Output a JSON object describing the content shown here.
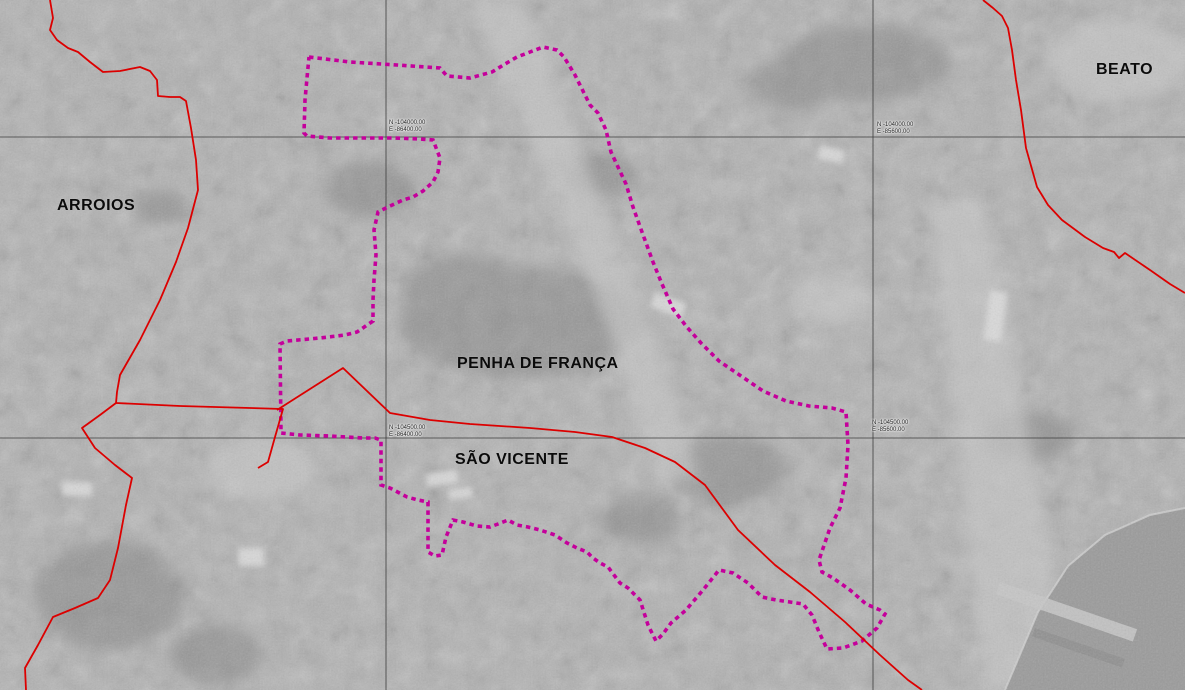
{
  "map": {
    "description": "Grayscale aerial orthophoto of Lisbon with parish boundaries and intervention area overlay",
    "colors": {
      "boundary_red": "#dc0000",
      "intervention_magenta": "#c4009b",
      "grid_black": "#3c3c3c",
      "photo_base_gray": "#b2b2b2"
    },
    "regions": [
      {
        "name": "ARROIOS",
        "x": 57,
        "y": 197
      },
      {
        "name": "PENHA DE FRANÇA",
        "x": 457,
        "y": 355
      },
      {
        "name": "SÃO VICENTE",
        "x": 455,
        "y": 451
      },
      {
        "name": "BEATO",
        "x": 1096,
        "y": 61
      }
    ],
    "grid": {
      "horizontal": [
        137,
        438
      ],
      "vertical": [
        386,
        873
      ],
      "labels": [
        {
          "n": "N -104000.00",
          "e": "E -86400.00",
          "x": 389,
          "y": 120
        },
        {
          "n": "N -104000.00",
          "e": "E -85600.00",
          "x": 877,
          "y": 122
        },
        {
          "n": "N -104500.00",
          "e": "E -86400.00",
          "x": 389,
          "y": 425
        },
        {
          "n": "N -104500.00",
          "e": "E -85600.00",
          "x": 872,
          "y": 420
        }
      ]
    },
    "boundaries": {
      "stroke_width": 1.8,
      "paths": [
        [
          [
            50,
            0
          ],
          [
            53,
            18
          ],
          [
            50,
            30
          ],
          [
            57,
            40
          ],
          [
            68,
            48
          ],
          [
            78,
            52
          ],
          [
            90,
            62
          ],
          [
            103,
            72
          ],
          [
            120,
            71
          ],
          [
            140,
            67
          ],
          [
            150,
            71
          ],
          [
            157,
            80
          ],
          [
            158,
            96
          ],
          [
            170,
            97
          ],
          [
            180,
            97
          ],
          [
            186,
            101
          ],
          [
            191,
            128
          ],
          [
            196,
            160
          ],
          [
            198,
            190
          ],
          [
            188,
            228
          ],
          [
            176,
            262
          ],
          [
            160,
            300
          ],
          [
            140,
            340
          ],
          [
            120,
            375
          ],
          [
            117,
            392
          ],
          [
            116,
            403
          ],
          [
            100,
            415
          ],
          [
            82,
            428
          ],
          [
            95,
            448
          ],
          [
            115,
            465
          ],
          [
            132,
            478
          ],
          [
            126,
            505
          ],
          [
            118,
            548
          ],
          [
            110,
            580
          ],
          [
            98,
            598
          ],
          [
            75,
            608
          ],
          [
            53,
            617
          ],
          [
            38,
            645
          ],
          [
            25,
            668
          ],
          [
            26,
            690
          ]
        ],
        [
          [
            116,
            403
          ],
          [
            180,
            406
          ],
          [
            250,
            408
          ],
          [
            283,
            409
          ],
          [
            275,
            437
          ],
          [
            268,
            462
          ],
          [
            258,
            468
          ]
        ],
        [
          [
            277,
            410
          ],
          [
            310,
            389
          ],
          [
            343,
            368
          ],
          [
            367,
            391
          ],
          [
            390,
            413
          ],
          [
            430,
            420
          ],
          [
            470,
            424
          ],
          [
            530,
            428
          ],
          [
            575,
            432
          ],
          [
            612,
            437
          ],
          [
            645,
            448
          ],
          [
            675,
            462
          ],
          [
            705,
            485
          ],
          [
            738,
            530
          ],
          [
            775,
            565
          ],
          [
            810,
            592
          ],
          [
            845,
            622
          ],
          [
            880,
            655
          ],
          [
            908,
            680
          ],
          [
            922,
            690
          ]
        ],
        [
          [
            983,
            0
          ],
          [
            993,
            8
          ],
          [
            1002,
            16
          ],
          [
            1008,
            28
          ],
          [
            1012,
            50
          ],
          [
            1016,
            80
          ],
          [
            1021,
            110
          ],
          [
            1026,
            148
          ],
          [
            1037,
            187
          ],
          [
            1048,
            205
          ],
          [
            1062,
            220
          ],
          [
            1085,
            237
          ],
          [
            1103,
            248
          ],
          [
            1114,
            252
          ],
          [
            1119,
            258
          ],
          [
            1125,
            253
          ],
          [
            1150,
            270
          ],
          [
            1170,
            284
          ],
          [
            1185,
            293
          ]
        ]
      ]
    },
    "intervention_area": {
      "stroke_width": 3.6,
      "dash": "4.5 4",
      "path": [
        [
          309,
          57
        ],
        [
          350,
          62
        ],
        [
          397,
          65
        ],
        [
          440,
          68
        ],
        [
          447,
          76
        ],
        [
          470,
          78
        ],
        [
          492,
          72
        ],
        [
          505,
          64
        ],
        [
          517,
          57
        ],
        [
          530,
          52
        ],
        [
          543,
          47
        ],
        [
          557,
          50
        ],
        [
          564,
          57
        ],
        [
          575,
          75
        ],
        [
          590,
          105
        ],
        [
          598,
          113
        ],
        [
          606,
          130
        ],
        [
          611,
          152
        ],
        [
          618,
          167
        ],
        [
          626,
          184
        ],
        [
          633,
          207
        ],
        [
          642,
          232
        ],
        [
          653,
          262
        ],
        [
          662,
          284
        ],
        [
          673,
          309
        ],
        [
          686,
          326
        ],
        [
          701,
          343
        ],
        [
          719,
          361
        ],
        [
          741,
          376
        ],
        [
          763,
          391
        ],
        [
          786,
          401
        ],
        [
          809,
          406
        ],
        [
          832,
          408
        ],
        [
          846,
          412
        ],
        [
          848,
          445
        ],
        [
          846,
          478
        ],
        [
          840,
          508
        ],
        [
          830,
          528
        ],
        [
          819,
          560
        ],
        [
          822,
          572
        ],
        [
          833,
          578
        ],
        [
          850,
          590
        ],
        [
          866,
          604
        ],
        [
          880,
          610
        ],
        [
          885,
          614
        ],
        [
          877,
          628
        ],
        [
          862,
          641
        ],
        [
          843,
          648
        ],
        [
          827,
          649
        ],
        [
          819,
          632
        ],
        [
          812,
          615
        ],
        [
          803,
          604
        ],
        [
          790,
          602
        ],
        [
          776,
          600
        ],
        [
          762,
          597
        ],
        [
          748,
          583
        ],
        [
          733,
          573
        ],
        [
          719,
          570
        ],
        [
          703,
          590
        ],
        [
          686,
          610
        ],
        [
          671,
          623
        ],
        [
          663,
          634
        ],
        [
          656,
          641
        ],
        [
          648,
          625
        ],
        [
          640,
          600
        ],
        [
          628,
          588
        ],
        [
          620,
          583
        ],
        [
          608,
          567
        ],
        [
          600,
          563
        ],
        [
          593,
          558
        ],
        [
          587,
          552
        ],
        [
          577,
          548
        ],
        [
          567,
          543
        ],
        [
          555,
          535
        ],
        [
          540,
          530
        ],
        [
          528,
          527
        ],
        [
          517,
          525
        ],
        [
          508,
          520
        ],
        [
          498,
          524
        ],
        [
          490,
          527
        ],
        [
          477,
          526
        ],
        [
          463,
          522
        ],
        [
          453,
          520
        ],
        [
          446,
          537
        ],
        [
          442,
          555
        ],
        [
          435,
          556
        ],
        [
          428,
          552
        ],
        [
          428,
          502
        ],
        [
          418,
          500
        ],
        [
          407,
          497
        ],
        [
          390,
          488
        ],
        [
          381,
          485
        ],
        [
          381,
          440
        ],
        [
          375,
          438
        ],
        [
          363,
          438
        ],
        [
          330,
          436
        ],
        [
          300,
          435
        ],
        [
          281,
          433
        ],
        [
          280,
          344
        ],
        [
          287,
          341
        ],
        [
          320,
          338
        ],
        [
          345,
          335
        ],
        [
          357,
          332
        ],
        [
          373,
          321
        ],
        [
          373,
          300
        ],
        [
          374,
          280
        ],
        [
          376,
          255
        ],
        [
          374,
          230
        ],
        [
          378,
          212
        ],
        [
          390,
          206
        ],
        [
          403,
          200
        ],
        [
          413,
          197
        ],
        [
          423,
          191
        ],
        [
          433,
          182
        ],
        [
          438,
          172
        ],
        [
          440,
          158
        ],
        [
          433,
          140
        ],
        [
          420,
          139
        ],
        [
          395,
          138
        ],
        [
          360,
          138
        ],
        [
          330,
          138
        ],
        [
          307,
          136
        ],
        [
          304,
          133
        ],
        [
          305,
          100
        ],
        [
          307,
          78
        ],
        [
          309,
          57
        ]
      ]
    }
  }
}
